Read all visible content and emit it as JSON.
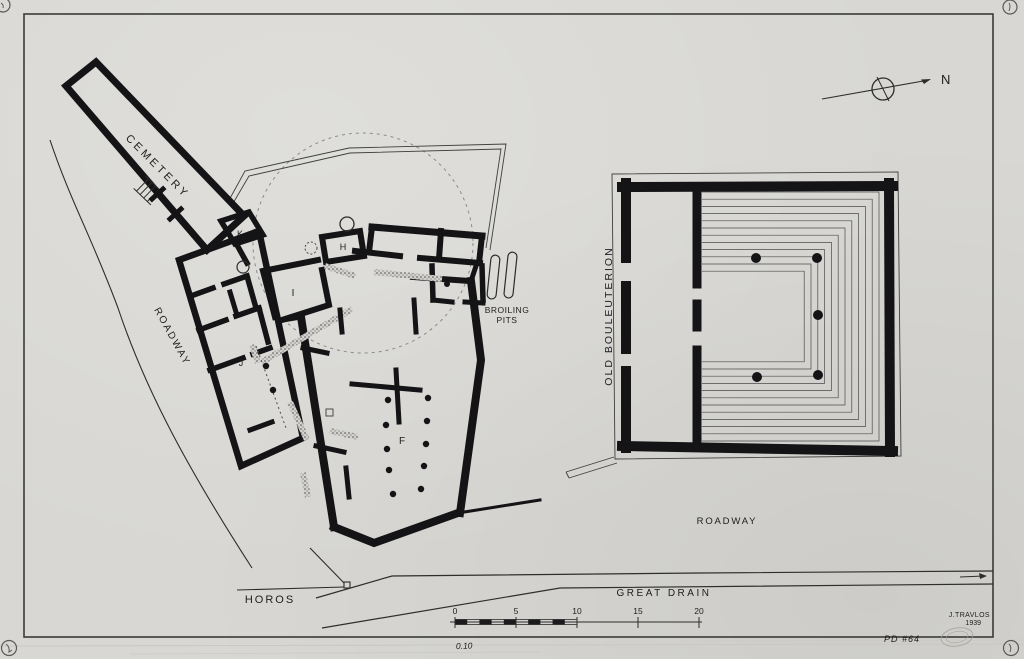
{
  "plan": {
    "labels": {
      "cemetery": "CEMETERY",
      "roadway_left": "ROADWAY",
      "roadway_bottom": "ROADWAY",
      "old_bouleuterion": "OLD BOULEUTERION",
      "broiling_pits_line1": "BROILING",
      "broiling_pits_line2": "PITS",
      "horos": "HOROS",
      "great_drain": "GREAT DRAIN",
      "north": "N"
    },
    "room_letters": {
      "f": "F",
      "h": "H",
      "i": "I",
      "j": "J",
      "k": "K"
    }
  },
  "scale_bar": {
    "ticks": [
      "0",
      "5",
      "10",
      "15",
      "20"
    ]
  },
  "annotations": {
    "signature_name": "J.TRAVLOS",
    "signature_year": "1939",
    "catalog_number": "PD #64",
    "pencil_note": "0.10"
  },
  "colors": {
    "paper": "#d8d7d3",
    "ink": "#1b1b1d",
    "faint_line": "#8a8a86"
  }
}
